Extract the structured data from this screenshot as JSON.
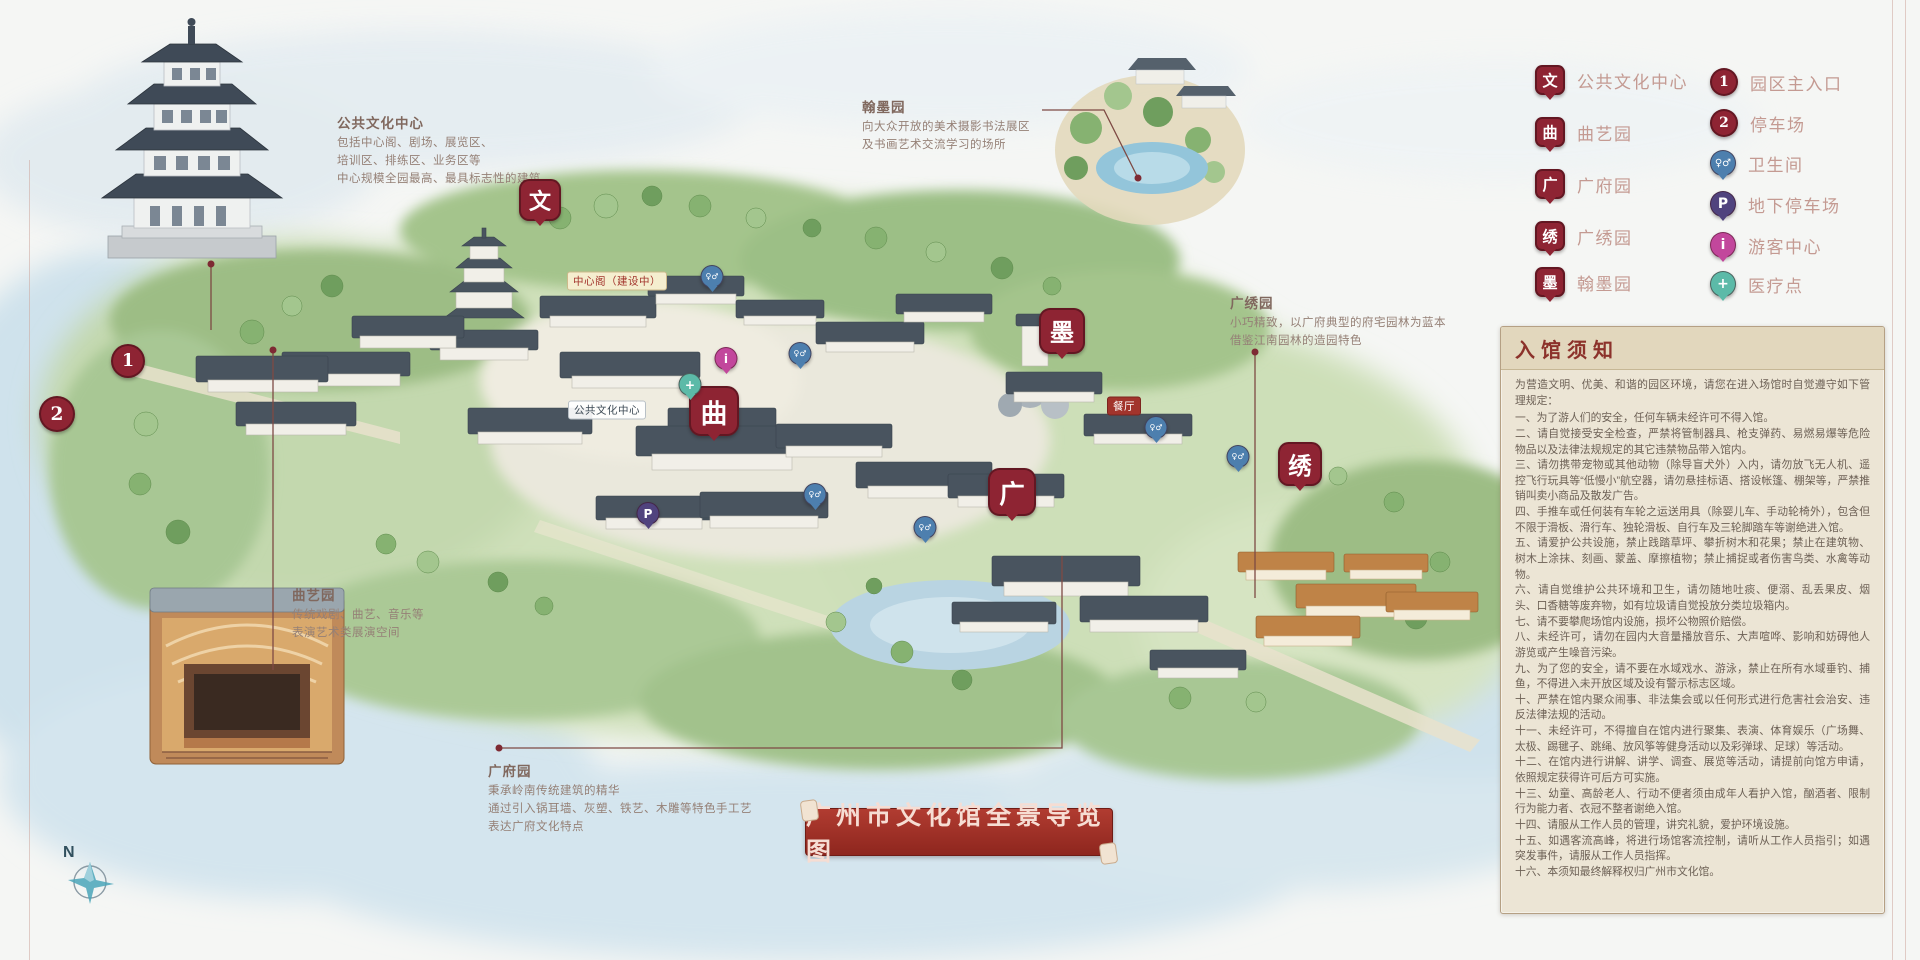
{
  "banner": {
    "text": "广州市文化馆全景导览图"
  },
  "compass": {
    "label": "N"
  },
  "legend": {
    "left": [
      {
        "glyph": "文",
        "label": "公共文化中心",
        "color": "#8e2433",
        "variant": "place",
        "size": 26,
        "x": 1535,
        "y": 80
      },
      {
        "glyph": "曲",
        "label": "曲艺园",
        "color": "#8e2433",
        "variant": "place",
        "size": 26,
        "x": 1535,
        "y": 132
      },
      {
        "glyph": "广",
        "label": "广府园",
        "color": "#8e2433",
        "variant": "place",
        "size": 26,
        "x": 1535,
        "y": 184
      },
      {
        "glyph": "绣",
        "label": "广绣园",
        "color": "#8e2433",
        "variant": "place",
        "size": 26,
        "x": 1535,
        "y": 236
      },
      {
        "glyph": "墨",
        "label": "翰墨园",
        "color": "#8e2433",
        "variant": "place",
        "size": 26,
        "x": 1535,
        "y": 282
      }
    ],
    "right": [
      {
        "glyph": "1",
        "label": "园区主入口",
        "color": "#8e2433",
        "variant": "circle",
        "size": 24,
        "x": 1710,
        "y": 82
      },
      {
        "glyph": "2",
        "label": "停车场",
        "color": "#8e2433",
        "variant": "circle",
        "size": 24,
        "x": 1710,
        "y": 123
      },
      {
        "glyph": "♀♂",
        "label": "卫生间",
        "color": "#4d7fae",
        "variant": "round",
        "size": 24,
        "fs": 10,
        "x": 1710,
        "y": 163
      },
      {
        "glyph": "P",
        "label": "地下停车场",
        "color": "#50437e",
        "variant": "round",
        "size": 24,
        "x": 1710,
        "y": 204
      },
      {
        "glyph": "i",
        "label": "游客中心",
        "color": "#c2479c",
        "variant": "round",
        "size": 24,
        "x": 1710,
        "y": 245
      },
      {
        "glyph": "+",
        "label": "医疗点",
        "color": "#5cbaa8",
        "variant": "round",
        "size": 24,
        "x": 1710,
        "y": 284
      }
    ]
  },
  "pins": [
    {
      "glyph": "文",
      "x": 540,
      "y": 221,
      "size": 38,
      "color": "#8e2433",
      "variant": "place"
    },
    {
      "glyph": "曲",
      "x": 714,
      "y": 436,
      "size": 46,
      "color": "#8e2433",
      "variant": "place"
    },
    {
      "glyph": "广",
      "x": 1012,
      "y": 516,
      "size": 44,
      "color": "#8e2433",
      "variant": "place"
    },
    {
      "glyph": "墨",
      "x": 1062,
      "y": 354,
      "size": 42,
      "color": "#8e2433",
      "variant": "place"
    },
    {
      "glyph": "绣",
      "x": 1300,
      "y": 486,
      "size": 40,
      "color": "#8e2433",
      "variant": "place"
    },
    {
      "glyph": "1",
      "x": 128,
      "y": 361,
      "size": 30,
      "color": "#8e2433",
      "variant": "circle"
    },
    {
      "glyph": "2",
      "x": 57,
      "y": 414,
      "size": 32,
      "color": "#8e2433",
      "variant": "circle"
    },
    {
      "glyph": "♀♂",
      "x": 712,
      "y": 288,
      "size": 21,
      "color": "#4d7fae",
      "variant": "round",
      "fs": 8
    },
    {
      "glyph": "♀♂",
      "x": 800,
      "y": 365,
      "size": 21,
      "color": "#4d7fae",
      "variant": "round",
      "fs": 8
    },
    {
      "glyph": "♀♂",
      "x": 815,
      "y": 506,
      "size": 21,
      "color": "#4d7fae",
      "variant": "round",
      "fs": 8
    },
    {
      "glyph": "♀♂",
      "x": 925,
      "y": 539,
      "size": 21,
      "color": "#4d7fae",
      "variant": "round",
      "fs": 8
    },
    {
      "glyph": "♀♂",
      "x": 1156,
      "y": 439,
      "size": 21,
      "color": "#4d7fae",
      "variant": "round",
      "fs": 8
    },
    {
      "glyph": "♀♂",
      "x": 1238,
      "y": 468,
      "size": 21,
      "color": "#4d7fae",
      "variant": "round",
      "fs": 8
    },
    {
      "glyph": "P",
      "x": 648,
      "y": 525,
      "size": 21,
      "color": "#50437e",
      "variant": "round"
    },
    {
      "glyph": "i",
      "x": 726,
      "y": 370,
      "size": 21,
      "color": "#c2479c",
      "variant": "round"
    },
    {
      "glyph": "+",
      "x": 690,
      "y": 396,
      "size": 21,
      "color": "#5cbaa8",
      "variant": "round"
    }
  ],
  "annotations": [
    {
      "title": "公共文化中心",
      "x": 337,
      "y": 112,
      "lines": [
        "包括中心阁、剧场、展览区、",
        "培训区、排练区、业务区等",
        "中心规模全园最高、最具标志性的建筑"
      ]
    },
    {
      "title": "翰墨园",
      "x": 862,
      "y": 96,
      "lines": [
        "向大众开放的美术摄影书法展区",
        "及书画艺术交流学习的场所"
      ]
    },
    {
      "title": "广绣园",
      "x": 1230,
      "y": 292,
      "lines": [
        "小巧精致，以广府典型的府宅园林为蓝本",
        "借鉴江南园林的造园特色"
      ]
    },
    {
      "title": "曲艺园",
      "x": 292,
      "y": 584,
      "lines": [
        "传统戏剧、曲艺、音乐等",
        "表演艺术类展演空间"
      ]
    },
    {
      "title": "广府园",
      "x": 488,
      "y": 760,
      "lines": [
        "秉承岭南传统建筑的精华",
        "通过引入锅耳墙、灰塑、铁艺、木雕等特色手工艺",
        "表达广府文化特点"
      ]
    }
  ],
  "map_labels": [
    {
      "text": "中心阁（建设中）",
      "x": 617,
      "y": 281,
      "variant": "beige"
    },
    {
      "text": "公共文化中心",
      "x": 607,
      "y": 410,
      "variant": "white"
    },
    {
      "text": "餐厅",
      "x": 1124,
      "y": 406,
      "variant": "red"
    }
  ],
  "notice": {
    "header": "入馆须知",
    "intro": "为营造文明、优美、和谐的园区环境，请您在进入场馆时自觉遵守如下管理规定：",
    "rules": [
      {
        "text": "一、为了游人们的安全，任何车辆未经许可不得入馆。"
      },
      {
        "text": "二、请自觉接受安全检查，严禁将管制器具、枪支弹药、易燃易爆等危险物品以及法律法规规定的其它违禁物品带入馆内。"
      },
      {
        "text": "三、请勿携带宠物或其他动物（除导盲犬外）入内，请勿放飞无人机、遥控飞行玩具等“低慢小”航空器，请勿悬挂标语、搭设帐篷、棚架等，严禁推销叫卖小商品及散发广告。"
      },
      {
        "text": "四、手推车或任何装有车轮之运送用具（除婴儿车、手动轮椅外），包含但不限于滑板、滑行车、独轮滑板、自行车及三轮脚踏车等谢绝进入馆。"
      },
      {
        "text": "五、请爱护公共设施，禁止践踏草坪、攀折树木和花果；禁止在建筑物、树木上涂抹、刻画、蒙盖、摩擦植物；禁止捕捉或者伤害鸟类、水禽等动物。"
      },
      {
        "text": "六、请自觉维护公共环境和卫生，请勿随地吐痰、便溺、乱丢果皮、烟头、口香糖等废弃物，如有垃圾请自觉投放分类垃圾箱内。"
      },
      {
        "text": "七、请不要攀爬场馆内设施，损坏公物照价赔偿。"
      },
      {
        "text": "八、未经许可，请勿在园内大音量播放音乐、大声喧哗、影响和妨碍他人游览或产生噪音污染。"
      },
      {
        "text": "九、为了您的安全，请不要在水域戏水、游泳，禁止在所有水域垂钓、捕鱼，不得进入未开放区域及设有警示标志区域。"
      },
      {
        "text": "十、严禁在馆内聚众闹事、非法集会或以任何形式进行危害社会治安、违反法律法规的活动。"
      },
      {
        "text": "十一、未经许可，不得擅自在馆内进行聚集、表演、体育娱乐（广场舞、太极、踢毽子、跳绳、放风筝等健身活动以及彩弹球、足球）等活动。"
      },
      {
        "text": "十二、在馆内进行讲解、讲学、调查、展览等活动，请提前向馆方申请，依照规定获得许可后方可实施。"
      },
      {
        "text": "十三、幼童、高龄老人、行动不便者须由成年人看护入馆，酗酒者、限制行为能力者、衣冠不整者谢绝入馆。"
      },
      {
        "text": "十四、请服从工作人员的管理，讲究礼貌，爱护环境设施。"
      },
      {
        "text": "十五、如遇客流高峰，将进行场馆客流控制，请听从工作人员指引；如遇突发事件，请服从工作人员指挥。"
      },
      {
        "text": "十六、本须知最终解释权归广州市文化馆。"
      }
    ]
  }
}
